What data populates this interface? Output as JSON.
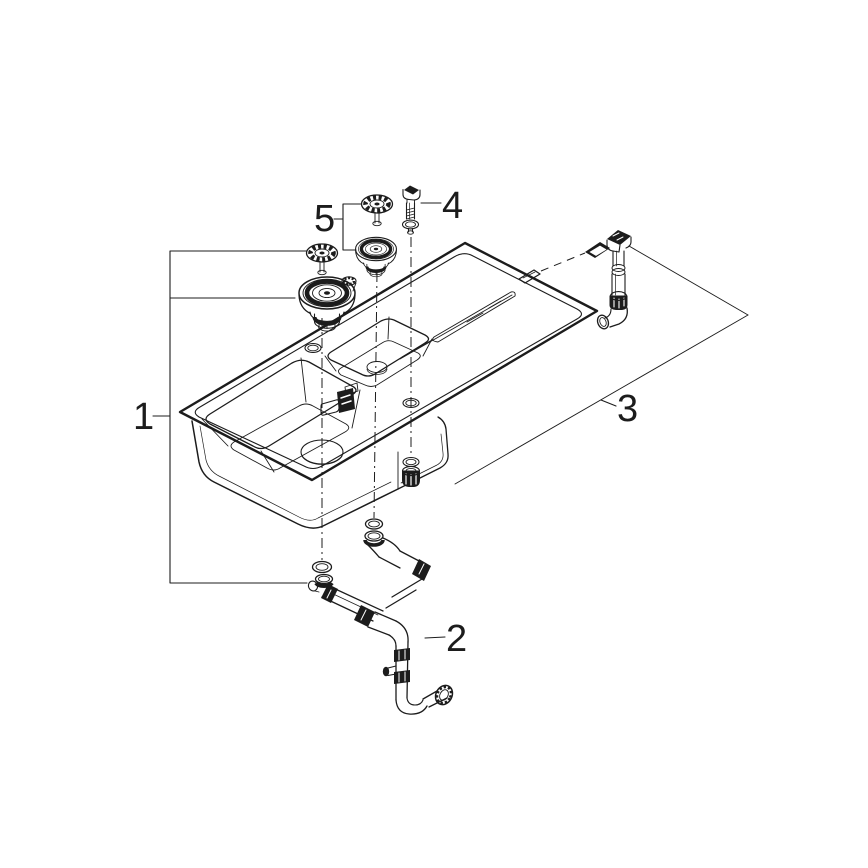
{
  "canvas": {
    "background": "#ffffff",
    "ink": "#1c1c1c"
  },
  "callouts": [
    {
      "label": "1"
    },
    {
      "label": "2"
    },
    {
      "label": "3"
    },
    {
      "label": "4"
    },
    {
      "label": "5"
    }
  ]
}
